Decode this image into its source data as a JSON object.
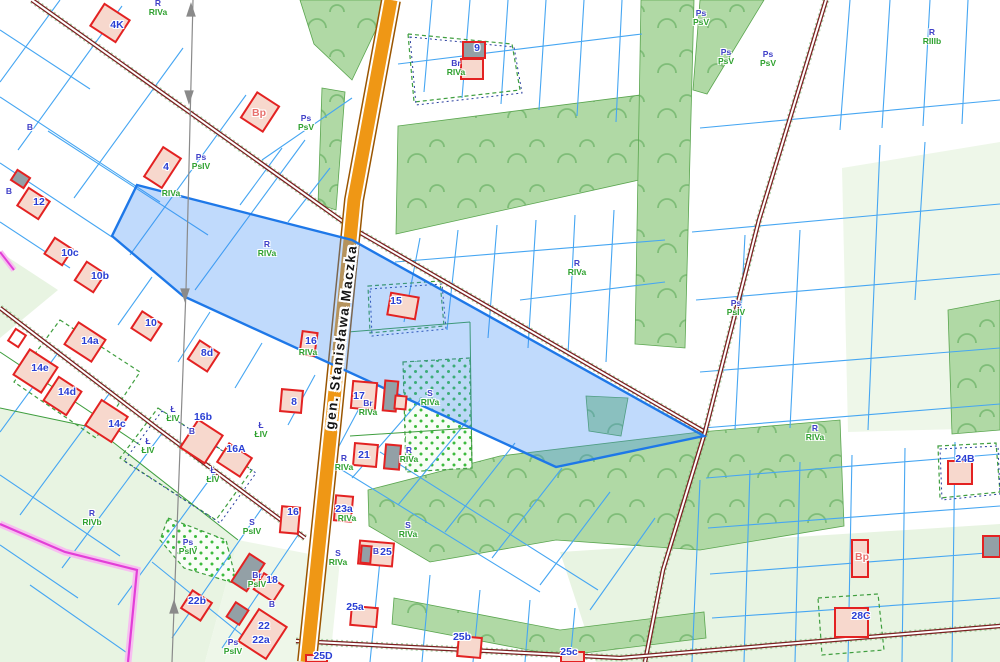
{
  "street": {
    "name": "gen. Stanisława Maczka"
  },
  "colors": {
    "selected_parcel_fill": "#3a8cf5",
    "selected_parcel_stroke": "#1e78e8",
    "road_orange": "#ef9715",
    "road_casing": "#9a5500",
    "road_minor": "#7a1f1f",
    "parcel_line": "#46a6f2",
    "landuse_line": "#3f9e3f",
    "class_line": "#2a3f9f",
    "building_stroke": "#e32222",
    "building_fill": "#f7d8cd",
    "building_gray": "#93a0a6",
    "meadow_green": "#b0d9a5",
    "light_green": "#e8f4e2",
    "utility_line": "#e23fd7",
    "label_blue": "#2a3fd4",
    "label_green": "#2fa12f"
  },
  "buildings": [
    {
      "label": "4K",
      "x": 117,
      "y": 25,
      "bx": 95,
      "by": 10,
      "w": 30,
      "h": 26,
      "r": 33,
      "f": "pink"
    },
    {
      "label": "Bp",
      "lc": "salmon",
      "x": 259,
      "y": 113,
      "bx": 247,
      "by": 97,
      "w": 26,
      "h": 30,
      "r": 33,
      "f": "pink"
    },
    {
      "label": "4",
      "x": 166,
      "y": 167,
      "bx": 152,
      "by": 150,
      "w": 21,
      "h": 35,
      "r": 33,
      "f": "pink"
    },
    {
      "label": "9",
      "x": 477,
      "y": 48,
      "bx": 463,
      "by": 42,
      "w": 22,
      "h": 16,
      "r": 0,
      "f": "gray"
    },
    {
      "label": "",
      "bx": 461,
      "by": 59,
      "w": 22,
      "h": 20,
      "r": 0,
      "f": "pink"
    },
    {
      "label": "12",
      "x": 39,
      "y": 202,
      "bx": 21,
      "by": 193,
      "w": 25,
      "h": 21,
      "r": 33,
      "f": "pink"
    },
    {
      "label": "",
      "bx": 13,
      "by": 173,
      "w": 15,
      "h": 12,
      "r": 33,
      "f": "gray"
    },
    {
      "label": "10c",
      "x": 70,
      "y": 253,
      "bx": 48,
      "by": 242,
      "w": 21,
      "h": 19,
      "r": 33,
      "f": "pink"
    },
    {
      "label": "10b",
      "x": 100,
      "y": 276,
      "bx": 79,
      "by": 266,
      "w": 22,
      "h": 22,
      "r": 33,
      "f": "pink"
    },
    {
      "label": "10",
      "x": 151,
      "y": 323,
      "bx": 135,
      "by": 316,
      "w": 23,
      "h": 20,
      "r": 33,
      "f": "pink"
    },
    {
      "label": "14a",
      "x": 90,
      "y": 341,
      "bx": 69,
      "by": 329,
      "w": 32,
      "h": 26,
      "r": 33,
      "f": "pink"
    },
    {
      "label": "",
      "bx": 11,
      "by": 331,
      "w": 12,
      "h": 14,
      "r": 33,
      "f": "white"
    },
    {
      "label": "14e",
      "x": 40,
      "y": 368,
      "bx": 19,
      "by": 356,
      "w": 33,
      "h": 30,
      "r": 33,
      "f": "pink"
    },
    {
      "label": "14d",
      "x": 67,
      "y": 392,
      "bx": 49,
      "by": 382,
      "w": 27,
      "h": 28,
      "r": 33,
      "f": "pink"
    },
    {
      "label": "14c",
      "x": 117,
      "y": 424,
      "bx": 91,
      "by": 406,
      "w": 31,
      "h": 30,
      "r": 33,
      "f": "pink"
    },
    {
      "label": "8d",
      "x": 207,
      "y": 353,
      "bx": 192,
      "by": 345,
      "w": 23,
      "h": 22,
      "r": 33,
      "f": "pink"
    },
    {
      "label": "15",
      "x": 396,
      "y": 301,
      "bx": 389,
      "by": 295,
      "w": 28,
      "h": 22,
      "r": 10,
      "f": "pink"
    },
    {
      "label": "16",
      "x": 311,
      "y": 341,
      "bx": 301,
      "by": 332,
      "w": 15,
      "h": 23,
      "r": 8,
      "f": "pink"
    },
    {
      "label": "17",
      "x": 359,
      "y": 396,
      "bx": 352,
      "by": 382,
      "w": 24,
      "h": 27,
      "r": 5,
      "f": "pink"
    },
    {
      "label": "",
      "bx": 384,
      "by": 381,
      "w": 13,
      "h": 30,
      "r": 5,
      "f": "gray"
    },
    {
      "label": "",
      "bx": 395,
      "by": 396,
      "w": 11,
      "h": 13,
      "r": 5,
      "f": "pink"
    },
    {
      "label": "21",
      "x": 364,
      "y": 455,
      "bx": 354,
      "by": 444,
      "w": 23,
      "h": 22,
      "r": 5,
      "f": "pink"
    },
    {
      "label": "",
      "bx": 385,
      "by": 445,
      "w": 15,
      "h": 24,
      "r": 5,
      "f": "gray"
    },
    {
      "label": "8",
      "x": 294,
      "y": 402,
      "bx": 281,
      "by": 390,
      "w": 21,
      "h": 22,
      "r": 5,
      "f": "pink"
    },
    {
      "label": "16b",
      "x": 203,
      "y": 417,
      "bx": 187,
      "by": 425,
      "w": 29,
      "h": 33,
      "r": 33,
      "f": "pink"
    },
    {
      "label": "16A",
      "x": 236,
      "y": 449,
      "bx": 221,
      "by": 449,
      "w": 27,
      "h": 22,
      "r": 33,
      "f": "pink"
    },
    {
      "label": "16",
      "x": 293,
      "y": 512,
      "bx": 281,
      "by": 507,
      "w": 18,
      "h": 26,
      "r": 5,
      "f": "pink"
    },
    {
      "label": "23a",
      "x": 344,
      "y": 509,
      "bx": 335,
      "by": 496,
      "w": 17,
      "h": 25,
      "r": 5,
      "f": "pink"
    },
    {
      "label": "25",
      "x": 386,
      "y": 552,
      "bx": 359,
      "by": 542,
      "w": 34,
      "h": 23,
      "r": 5,
      "f": "pink"
    },
    {
      "label": "",
      "bx": 361,
      "by": 546,
      "w": 10,
      "h": 17,
      "r": 5,
      "f": "gray"
    },
    {
      "label": "25a",
      "x": 355,
      "y": 607,
      "bx": 351,
      "by": 607,
      "w": 26,
      "h": 19,
      "r": 5,
      "f": "pink"
    },
    {
      "label": "25b",
      "x": 462,
      "y": 637,
      "bx": 458,
      "by": 637,
      "w": 23,
      "h": 20,
      "r": 5,
      "f": "pink"
    },
    {
      "label": "25c",
      "x": 569,
      "y": 652,
      "bx": 561,
      "by": 652,
      "w": 23,
      "h": 10,
      "r": 0,
      "f": "pink"
    },
    {
      "label": "25D",
      "x": 323,
      "y": 656,
      "bx": 306,
      "by": 655,
      "w": 21,
      "h": 7,
      "r": 0,
      "f": "pink"
    },
    {
      "label": "22b",
      "x": 197,
      "y": 601,
      "bx": 185,
      "by": 595,
      "w": 23,
      "h": 21,
      "r": 33,
      "f": "pink"
    },
    {
      "label": "",
      "bx": 230,
      "by": 605,
      "w": 15,
      "h": 17,
      "r": 33,
      "f": "gray"
    },
    {
      "label": "22",
      "x": 264,
      "y": 626,
      "bx": 246,
      "by": 615,
      "w": 33,
      "h": 38,
      "r": 33,
      "f": "pink"
    },
    {
      "label": "22a",
      "x": 261,
      "y": 640
    },
    {
      "label": "18",
      "x": 272,
      "y": 580,
      "bx": 257,
      "by": 578,
      "w": 23,
      "h": 19,
      "r": 33,
      "f": "pink"
    },
    {
      "label": "",
      "bx": 239,
      "by": 556,
      "w": 18,
      "h": 33,
      "r": 33,
      "f": "gray"
    },
    {
      "label": "24B",
      "x": 965,
      "y": 459,
      "bx": 948,
      "by": 461,
      "w": 24,
      "h": 23,
      "r": 0,
      "f": "pink"
    },
    {
      "label": "Bp",
      "lc": "salmon",
      "x": 862,
      "y": 557,
      "bx": 852,
      "by": 540,
      "w": 16,
      "h": 37,
      "r": 0,
      "f": "pink"
    },
    {
      "label": "28C",
      "x": 861,
      "y": 616,
      "bx": 835,
      "by": 608,
      "w": 33,
      "h": 29,
      "r": 0,
      "f": "pink"
    },
    {
      "label": "",
      "bx": 983,
      "by": 536,
      "w": 17,
      "h": 21,
      "r": 0,
      "f": "gray"
    }
  ],
  "landuse_labels": [
    {
      "a": "R",
      "b": "RIVa",
      "x": 158,
      "y": 8
    },
    {
      "a": "R",
      "b": "RIVa",
      "x": 267,
      "y": 249
    },
    {
      "a": "Ps",
      "b": "PsIV",
      "x": 201,
      "y": 162
    },
    {
      "a": "Br",
      "b": "RIVa",
      "x": 456,
      "y": 68
    },
    {
      "a": "Ps",
      "b": "PsV",
      "x": 306,
      "y": 123
    },
    {
      "a": "Ps",
      "b": "PsV",
      "x": 701,
      "y": 18
    },
    {
      "a": "Ps",
      "b": "PsV",
      "x": 726,
      "y": 57
    },
    {
      "a": "Ps",
      "b": "PsV",
      "x": 768,
      "y": 59
    },
    {
      "a": "R",
      "b": "RIIIb",
      "x": 932,
      "y": 37
    },
    {
      "a": "R",
      "b": "RIVa",
      "x": 577,
      "y": 268
    },
    {
      "a": "Ps",
      "b": "PsIV",
      "x": 736,
      "y": 308
    },
    {
      "a": "R",
      "b": "RIVa",
      "x": 815,
      "y": 433
    },
    {
      "a": "R",
      "b": "RIVb",
      "x": 92,
      "y": 518
    },
    {
      "a": "S",
      "b": "PsIV",
      "x": 252,
      "y": 527
    },
    {
      "a": "Ps",
      "b": "PsIV",
      "x": 188,
      "y": 547
    },
    {
      "a": "Br",
      "b": "PsIV",
      "x": 257,
      "y": 580
    },
    {
      "a": "Ps",
      "b": "PsIV",
      "x": 233,
      "y": 647
    },
    {
      "a": "Ł",
      "b": "ŁIV",
      "x": 261,
      "y": 430
    },
    {
      "a": "Ł",
      "b": "ŁIV",
      "x": 213,
      "y": 475
    },
    {
      "a": "Ł",
      "b": "ŁIV",
      "x": 148,
      "y": 446
    },
    {
      "a": "Ł",
      "b": "ŁIV",
      "x": 173,
      "y": 414
    },
    {
      "a": "S",
      "b": "RIVa",
      "x": 430,
      "y": 398
    },
    {
      "a": "S",
      "b": "RIVa",
      "x": 408,
      "y": 530
    },
    {
      "a": "S",
      "b": "RIVa",
      "x": 338,
      "y": 558
    },
    {
      "a": "R",
      "b": "RIVa",
      "x": 344,
      "y": 463
    },
    {
      "a": "R",
      "b": "RIVa",
      "x": 409,
      "y": 455
    },
    {
      "a": "Br",
      "b": "RIVa",
      "x": 368,
      "y": 408
    }
  ],
  "single_labels": [
    {
      "t": "B",
      "x": 30,
      "y": 127,
      "c": "b"
    },
    {
      "t": "B",
      "x": 9,
      "y": 191,
      "c": "b"
    },
    {
      "t": "B",
      "x": 272,
      "y": 604,
      "c": "b"
    },
    {
      "t": "B",
      "x": 192,
      "y": 431,
      "c": "b"
    },
    {
      "t": "B",
      "x": 376,
      "y": 551,
      "c": "b"
    },
    {
      "t": "RIVa",
      "x": 171,
      "y": 193,
      "c": "g"
    },
    {
      "t": "RIVa",
      "x": 308,
      "y": 352,
      "c": "g"
    },
    {
      "t": "RIVa",
      "x": 347,
      "y": 518,
      "c": "g"
    }
  ]
}
